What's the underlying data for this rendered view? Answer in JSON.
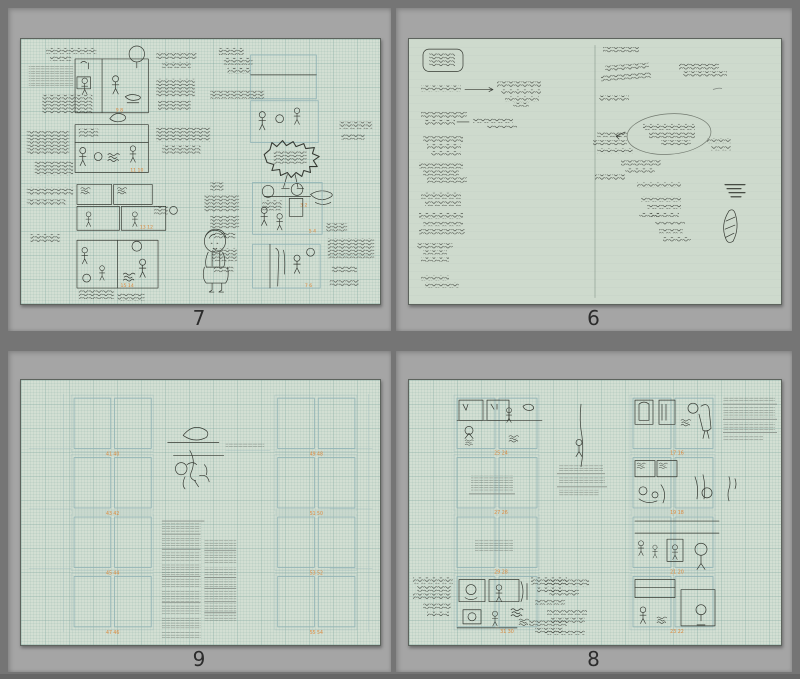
{
  "window": {
    "background_color": "#757575",
    "cell_color": "#a5a5a5"
  },
  "paper": {
    "grid_paper_color": "#d3dfd3",
    "plain_paper_color": "#cedacd",
    "grid_line_color": "#9fc0ba",
    "ink_color": "#343831",
    "accent_orange": "#dd8a3e",
    "caption_color": "#2c2c2c"
  },
  "pages": [
    {
      "caption": "7",
      "panel_numbers": [
        "9 8",
        "11 10",
        "13 12",
        "15 14",
        "3 2",
        "5 4",
        "7 6"
      ]
    },
    {
      "caption": "6",
      "panel_numbers": []
    },
    {
      "caption": "9",
      "panel_numbers": [
        "41 40",
        "43 42",
        "45 44",
        "47 46",
        "49 48",
        "51 50",
        "53 52",
        "55 54"
      ]
    },
    {
      "caption": "8",
      "panel_numbers": [
        "25 24",
        "27 26",
        "29 28",
        "31 30",
        "17 16",
        "19 18",
        "21 20",
        "23 22"
      ]
    }
  ]
}
